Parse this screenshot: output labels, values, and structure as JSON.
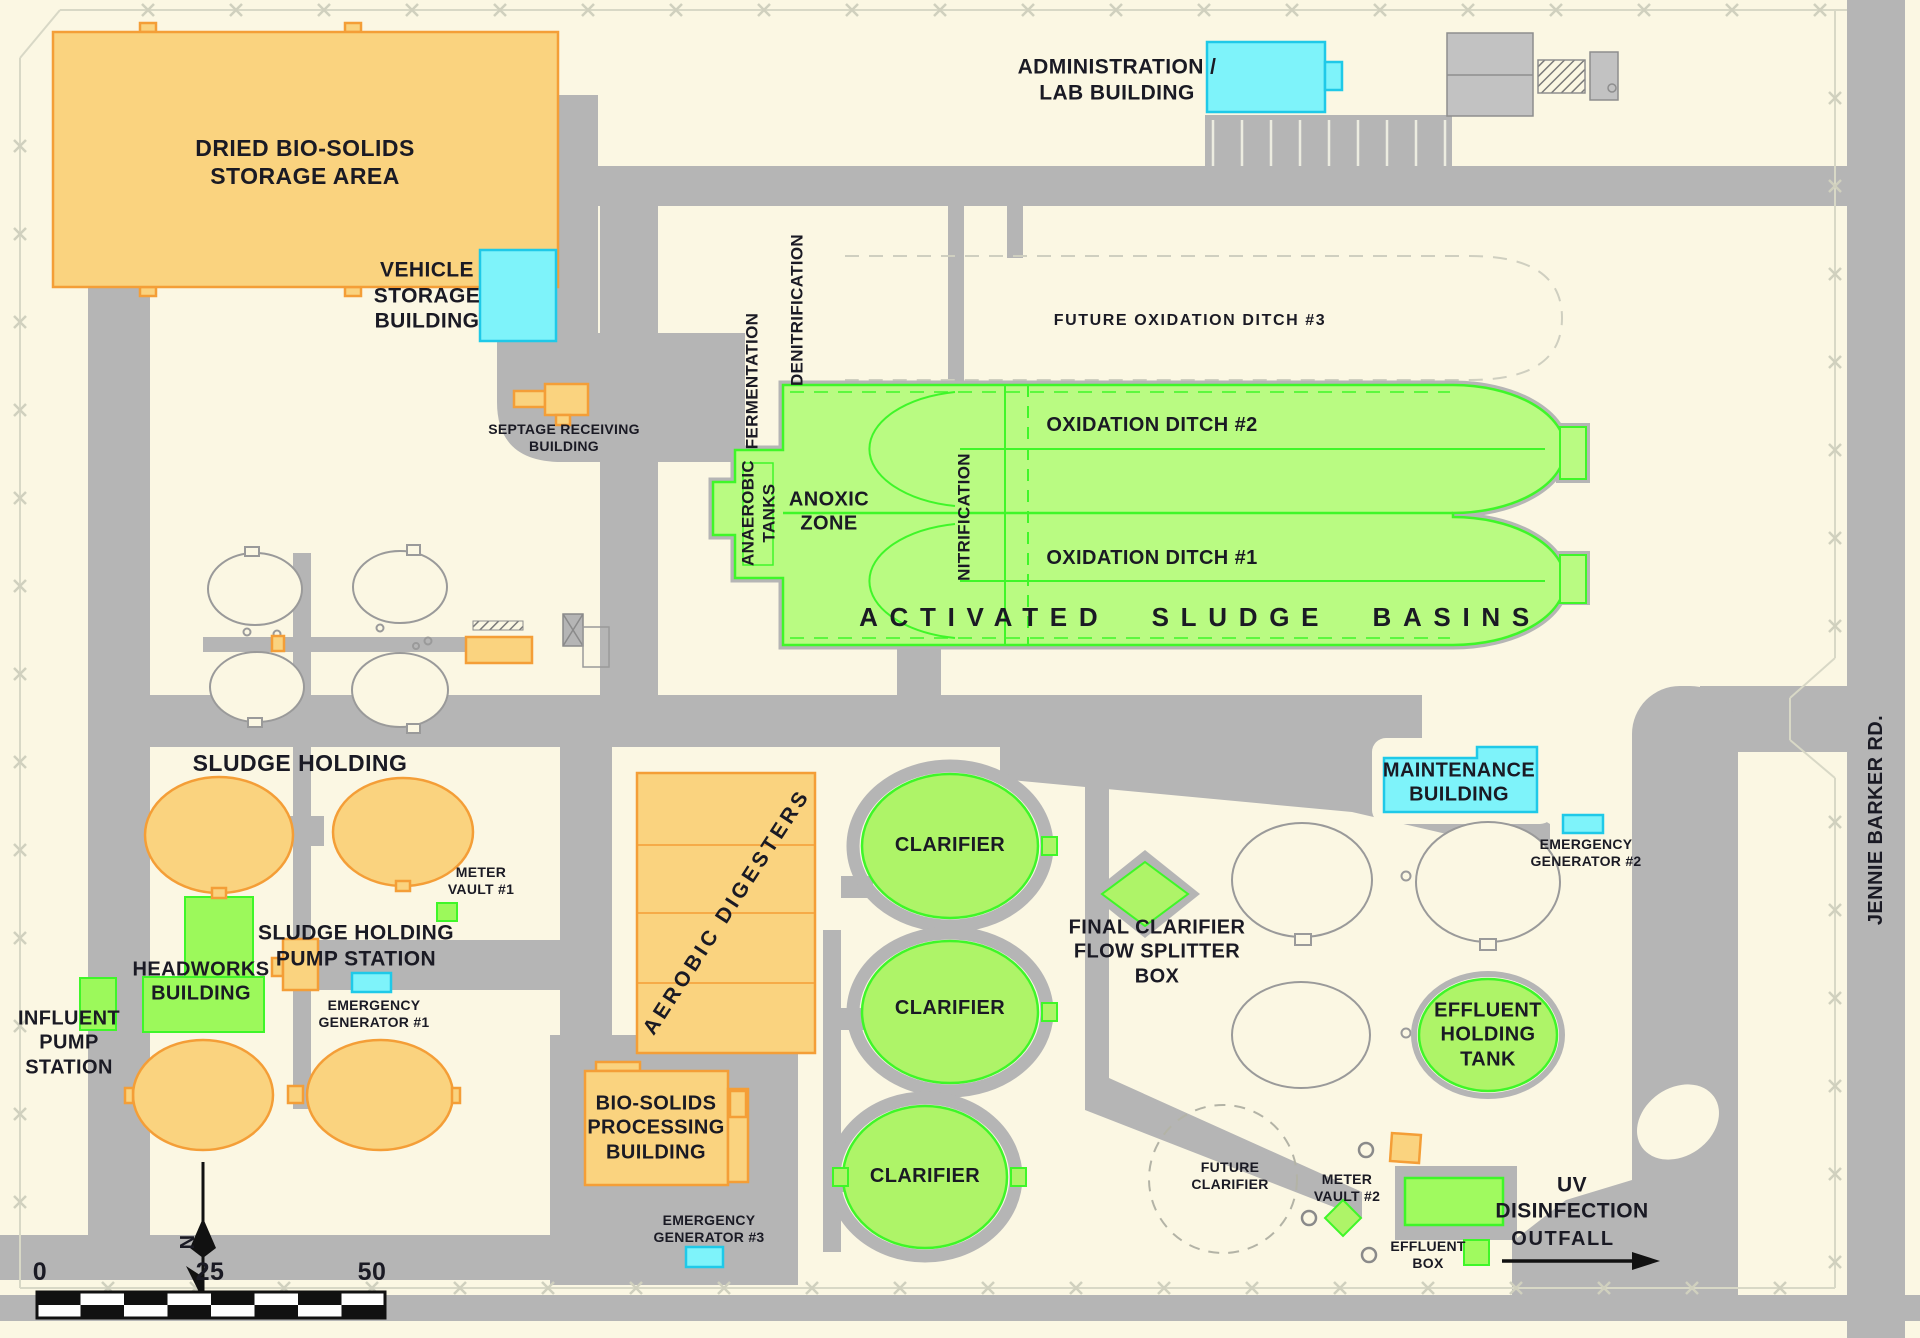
{
  "title": "Wastewater Treatment Plant Site Plan",
  "colors": {
    "background": "#FBF7E3",
    "road_gray": "#B5B5B5",
    "building_orange": "#FAD37F",
    "building_orange_border": "#F49E37",
    "process_green_fill": "#B9FB82",
    "process_green_border": "#3FF629",
    "clarifier_green": "#AEF468",
    "building_cyan": "#7EF3FA",
    "building_cyan_border": "#1FC9E8",
    "future_outline_gray": "#9A9A9A",
    "fence_line": "#D8D8C6",
    "text": "#1A1A24"
  },
  "labels": {
    "dried_biosolids": "DRIED BIO-SOLIDS\nSTORAGE AREA",
    "vehicle_storage": "VEHICLE\nSTORAGE\nBUILDING",
    "septage_receiving": "SEPTAGE RECEIVING\nBUILDING",
    "administration": "ADMINISTRATION /\nLAB BUILDING",
    "future_oxidation_ditch_3": "FUTURE OXIDATION DITCH #3",
    "oxidation_ditch_2": "OXIDATION DITCH #2",
    "oxidation_ditch_1": "OXIDATION DITCH #1",
    "activated_sludge_basins": "ACTIVATED SLUDGE BASINS",
    "anoxic_zone": "ANOXIC\nZONE",
    "anaerobic_tanks": "ANAEROBIC\nTANKS",
    "fermentation": "FERMENTATION",
    "denitrification": "DENITRIFICATION",
    "nitrification": "NITRIFICATION",
    "sludge_holding_upper": "SLUDGE HOLDING",
    "sludge_holding_lower": "SLUDGE HOLDING",
    "meter_vault_1": "METER\nVAULT #1",
    "sludge_holding_pump_station": "SLUDGE HOLDING\nPUMP STATION",
    "headworks": "HEADWORKS\nBUILDING",
    "influent_pump_station": "INFLUENT\nPUMP\nSTATION",
    "emergency_generator_1": "EMERGENCY\nGENERATOR #1",
    "emergency_generator_2": "EMERGENCY\nGENERATOR #2",
    "emergency_generator_3": "EMERGENCY\nGENERATOR #3",
    "aerobic_digesters": "AEROBIC  DIGESTERS",
    "biosolids_processing": "BIO-SOLIDS\nPROCESSING\nBUILDING",
    "clarifier_1": "CLARIFIER",
    "clarifier_2": "CLARIFIER",
    "clarifier_3": "CLARIFIER",
    "final_clarifier_flow_splitter": "FINAL CLARIFIER\nFLOW SPLITTER\nBOX",
    "maintenance": "MAINTENANCE\nBUILDING",
    "effluent_holding_tank": "EFFLUENT\nHOLDING\nTANK",
    "future_clarifier": "FUTURE\nCLARIFIER",
    "meter_vault_2": "METER\nVAULT #2",
    "uv_disinfection": "UV\nDISINFECTION",
    "effluent_box": "EFFLUENT\nBOX",
    "outfall": "OUTFALL",
    "jennie_barker_rd": "JENNIE BARKER RD.",
    "north": "N"
  },
  "scale_bar": {
    "zero": "0",
    "twentyfive": "25",
    "fifty": "50"
  }
}
